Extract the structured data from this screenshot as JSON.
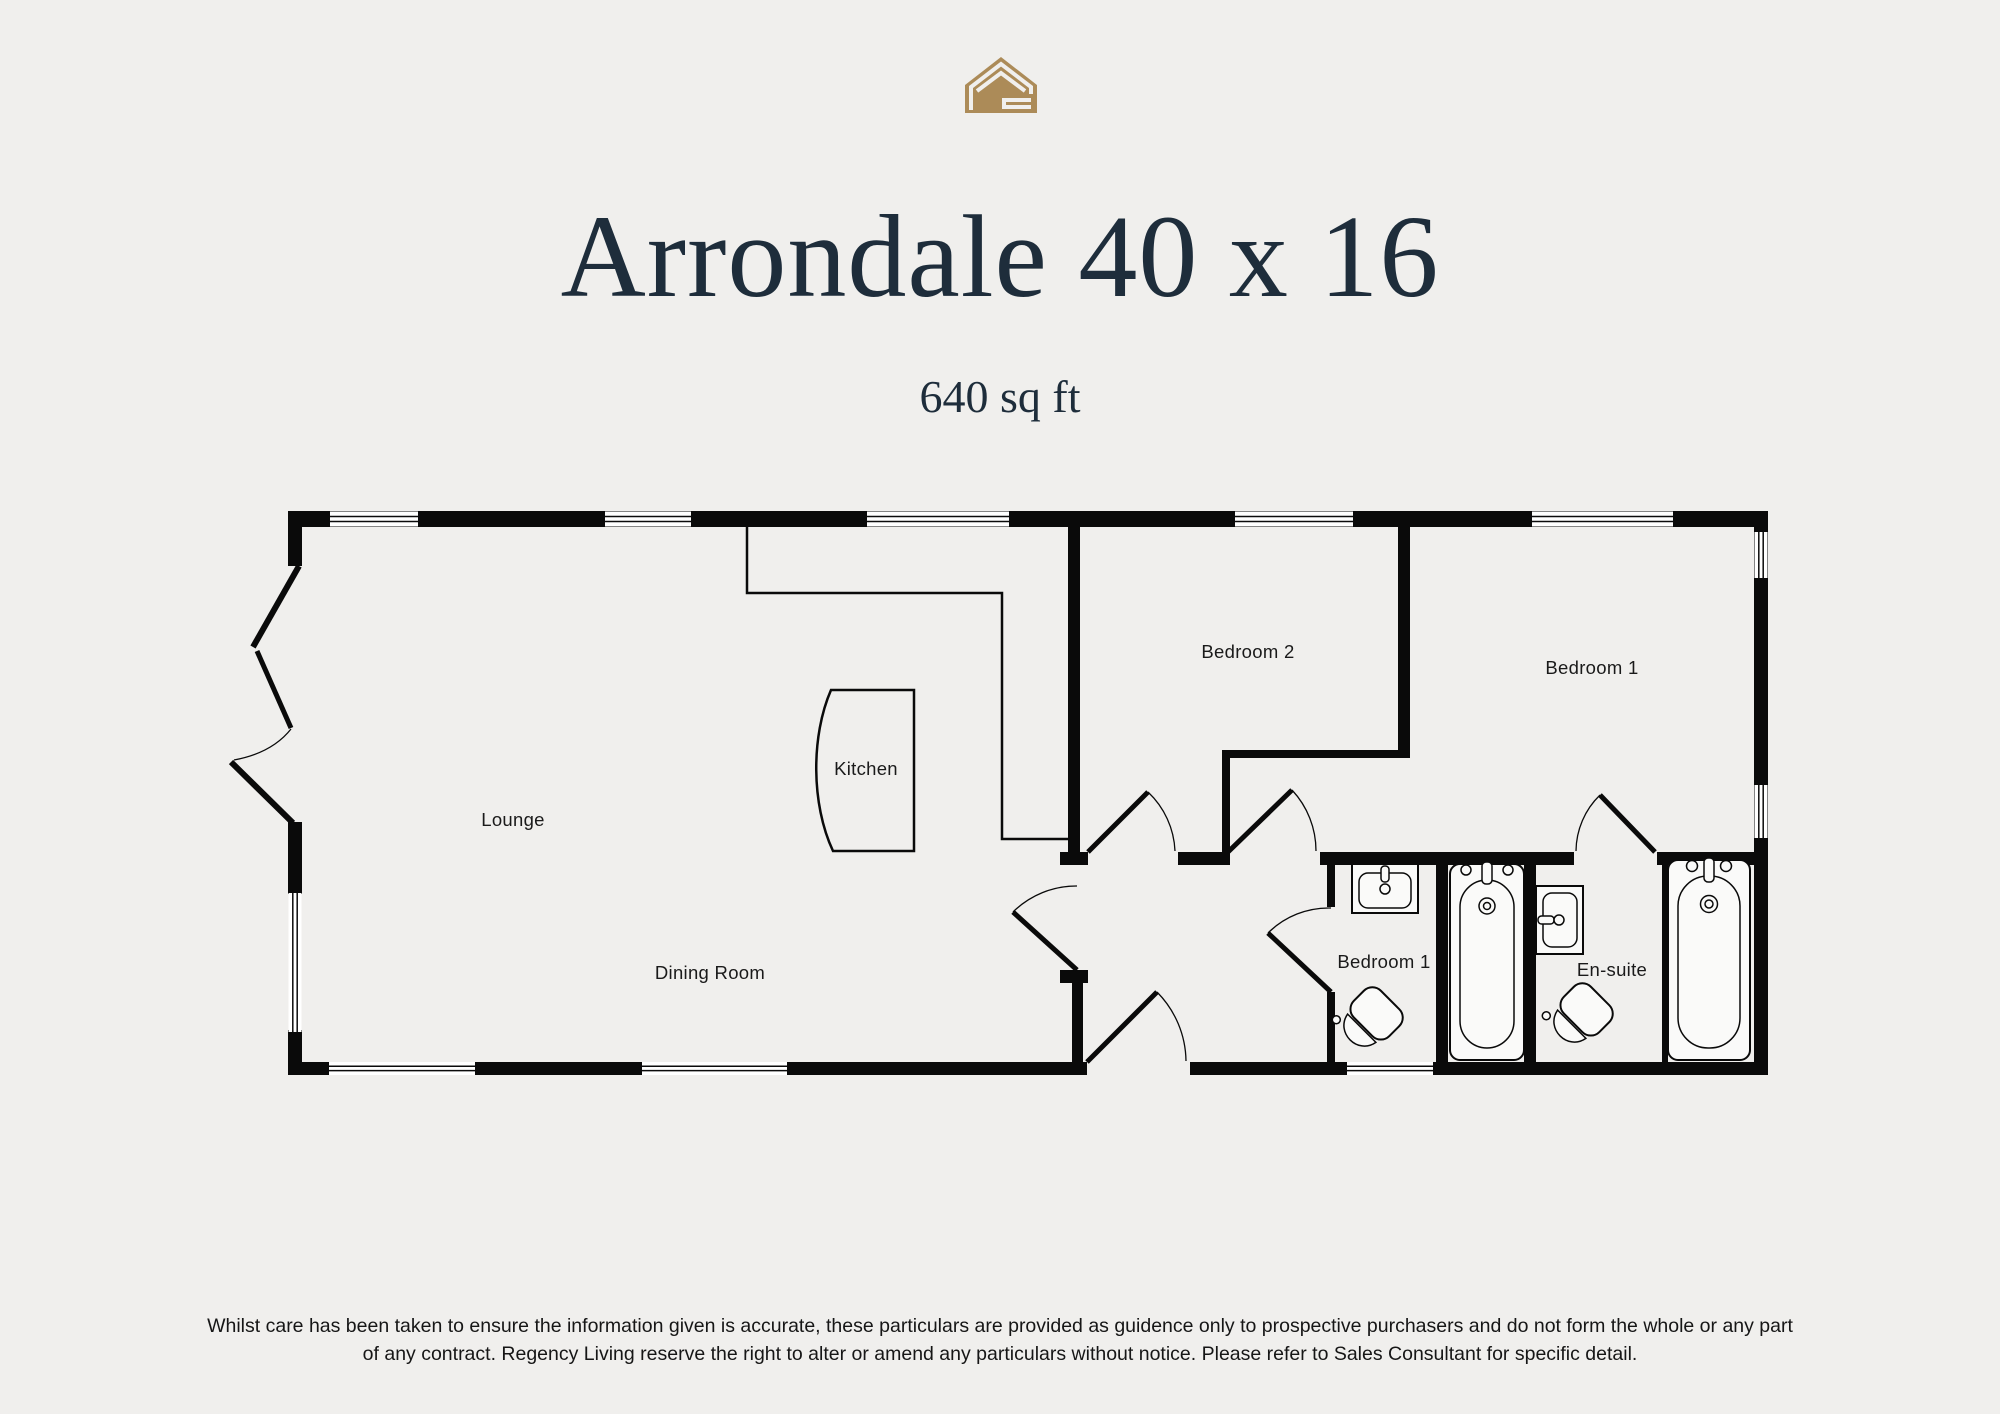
{
  "header": {
    "title": "Arrondale 40 x 16",
    "subtitle": "640 sq ft"
  },
  "logo": {
    "gold": "#ac8b58"
  },
  "floorplan": {
    "rooms": [
      {
        "id": "lounge",
        "label": "Lounge"
      },
      {
        "id": "dining-room",
        "label": "Dining Room"
      },
      {
        "id": "kitchen",
        "label": "Kitchen"
      },
      {
        "id": "bedroom-2",
        "label": "Bedroom 2"
      },
      {
        "id": "bedroom-1",
        "label": "Bedroom 1"
      },
      {
        "id": "bathroom",
        "label": "Bedroom 1"
      },
      {
        "id": "en-suite",
        "label": "En-suite"
      }
    ]
  },
  "footer": {
    "disclaimer_line1": "Whilst care has been taken to ensure the information given is accurate, these particulars are provided as guidence only to prospective purchasers and do not form the whole or any part",
    "disclaimer_line2": "of any contract. Regency Living reserve the right to alter or amend any particulars without notice. Please refer to Sales Consultant for specific detail."
  },
  "colors": {
    "background": "#f0efed",
    "wall": "#0a0a0a",
    "title_navy": "#1e2d3b",
    "logo_gold": "#ac8b58"
  }
}
